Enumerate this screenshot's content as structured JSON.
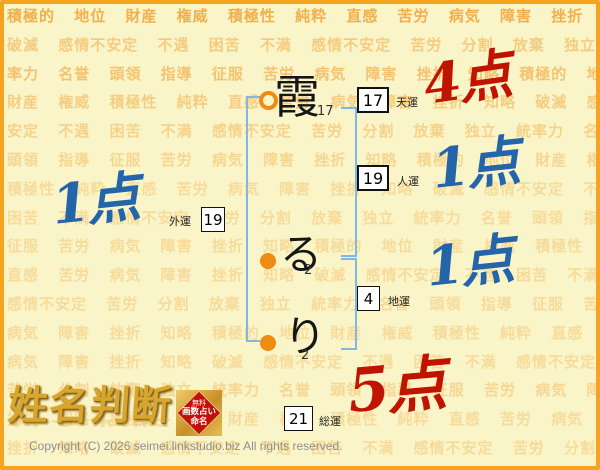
{
  "background": {
    "rows": [
      "積極的 地位 財産 権威 積極性 純粋 直感 苦労 病気 障害 挫折 知略",
      "破滅 感情不安定 不遇 困苦 不満 感情不安定 苦労 分割 放棄 独立 統",
      "率力 名誉 頭領 指導 征服 苦労 病気 障害 挫折 知略 積極的 地位",
      "財産 権威 積極性 純粋 直感 苦労 病気 障害 挫折 知略 破滅 感情不",
      "安定 不遇 困苦 不満 感情不安定 苦労 分割 放棄 独立 統率力 名誉",
      "頭領 指導 征服 苦労 病気 障害 挫折 知略 積極的 地位 財産 権威",
      "積極性 純粋 直感 苦労 病気 障害 挫折 知略 破滅 感情不安定 不遇",
      "困苦 不満 感情不安定 苦労 分割 放棄 独立 統率力 名誉 頭領 指導",
      "征服 苦労 病気 障害 挫折 知略 積極的 地位 財産 権威 積極性 純粋",
      "直感 苦労 病気 障害 挫折 知略 破滅 感情不安定 不遇 困苦 不満",
      "感情不安定 苦労 分割 放棄 独立 統率力 名誉 頭領 指導 征服 苦労",
      "病気 障害 挫折 知略 積極的 地位 財産 権威 積極性 純粋 直感 苦労",
      "病気 障害 挫折 知略 破滅 感情不安定 不遇 困苦 不満 感情不安定",
      "苦労 分割 放棄 独立 統率力 名誉 頭領 指導 征服 苦労 病気 障害",
      "挫折 知略 積極的 地位 財産 権威 積極性 純粋 直感 苦労 病気 障害",
      "挫折 知略 破滅 感情不安定 不遇 困苦 不満 感情不安定 苦労 分割"
    ]
  },
  "chart": {
    "name": [
      {
        "char": "霞",
        "strokes": "17"
      },
      {
        "char": "る",
        "strokes": "2"
      },
      {
        "char": "り",
        "strokes": "2"
      }
    ],
    "fortunes": {
      "tenun": {
        "label": "天運",
        "value": "17",
        "score": "4点"
      },
      "jinun": {
        "label": "人運",
        "value": "19",
        "score": "1点"
      },
      "chiun": {
        "label": "地運",
        "value": "4",
        "score": "1点"
      },
      "gaiun": {
        "label": "外運",
        "value": "19",
        "score": "1点"
      },
      "soun": {
        "label": "総運",
        "value": "21",
        "score": "5点"
      }
    }
  },
  "logo": {
    "title": "姓名判断",
    "badge": {
      "line1": "無料",
      "line2": "画数占い",
      "line3": "命名"
    }
  },
  "colors": {
    "score_red": "#C01400",
    "score_blue": "#2365A8",
    "accent_orange": "#F6A41F",
    "bracket_blue": "#7FB7E6",
    "marker_orange": "#EF8A12",
    "badge_red": "#C01008"
  },
  "footer": {
    "copyright": "Copyright (C) 2026 seimei.linkstudio.biz All rights reserved."
  }
}
